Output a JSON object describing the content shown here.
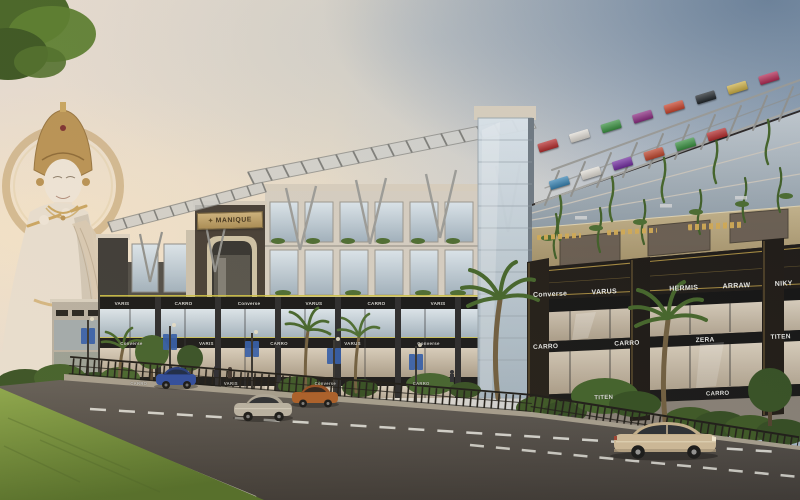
{
  "scene": {
    "title": "High-street commercial retail complex with Krishna statue — architectural render"
  },
  "entrance_sign": {
    "label": "MANIQUE"
  },
  "center_building": {
    "sign_rows": {
      "row1": [
        "VARIS",
        "CARRO",
        "Converse",
        "VARUS",
        "CARRO",
        "VARIS"
      ],
      "row2": [
        "Converse",
        "VARIS",
        "CARRO",
        "VARUS",
        "Converse"
      ],
      "row3": [
        "CARRO",
        "VARIS",
        "Converse",
        "CARRO"
      ]
    }
  },
  "right_building": {
    "sign_rows": {
      "row1": [
        "Converse",
        "VARUS",
        "HERMIS",
        "ARRAW",
        "NIKY"
      ],
      "row2": [
        "CARRO",
        "CARRO",
        "ZERA",
        "TITEN"
      ],
      "row3": [
        "TITEN",
        "CARRO"
      ]
    },
    "top_signboards": [
      {
        "color": "#b81f1f"
      },
      {
        "color": "#e8e3da"
      },
      {
        "color": "#2e8f35"
      },
      {
        "color": "#8a1f7d"
      },
      {
        "color": "#cf3a1e"
      },
      {
        "color": "#14191d"
      },
      {
        "color": "#d4b23a"
      },
      {
        "color": "#b81f4b"
      },
      {
        "color": "#2a7fb5"
      },
      {
        "color": "#e8e3da"
      },
      {
        "color": "#6d1fa0"
      },
      {
        "color": "#c23a1e"
      },
      {
        "color": "#2e8f35"
      },
      {
        "color": "#b81f1f"
      }
    ]
  },
  "palette": {
    "accent_gold": "#c9a545",
    "sign_band_black": "#0d0d0d",
    "tan_band": "#b3a077",
    "sky_blue": "#9cafc2",
    "sky_warm": "#ecdfca",
    "grass_green": "#6a8a34",
    "road_asphalt": "#4a453f",
    "facade_dark": "#3a3a3c",
    "statue_marble": "#e9dfd0",
    "statue_gold": "#b8904f"
  }
}
